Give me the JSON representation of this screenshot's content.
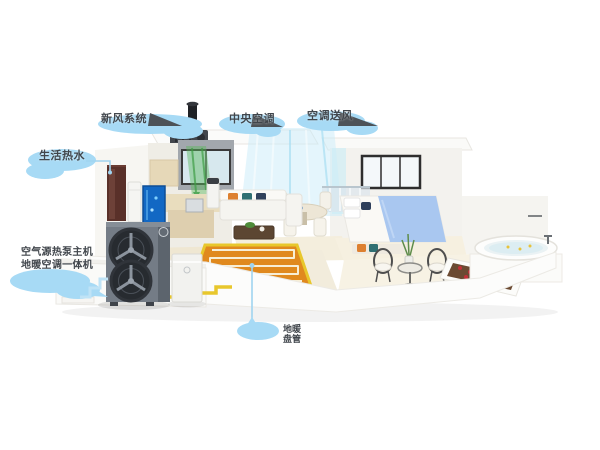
{
  "scene": {
    "alt": "Isometric cutaway of a house showing an air-source heat pump heating, cooling, fresh-air and hot-water system",
    "palette": {
      "callout_bubble": "#A7DAF5",
      "callout_text": "#41464C",
      "leader_line": "#A0D4F0",
      "pointer_arrow": "#4D5257",
      "pipe_yellow": "#E8C72C",
      "floor_heating_orange": "#E0891E",
      "heat_pump_gray": "#747C86",
      "airflow_blue": "#C9ECF9",
      "airflow_green": "#5CB85E",
      "bed_blanket_blue": "#A9C7F0"
    }
  },
  "callouts": {
    "fresh_air": {
      "label": "新风系统"
    },
    "central_ac": {
      "label": "中央空调"
    },
    "ac_supply": {
      "label": "空调送风"
    },
    "hot_water": {
      "label": "生活热水"
    },
    "heat_pump": {
      "line1": "空气源热泵主机",
      "line2": "地暖空调一体机"
    },
    "floor_heating": {
      "label": "地暖盘管"
    }
  }
}
